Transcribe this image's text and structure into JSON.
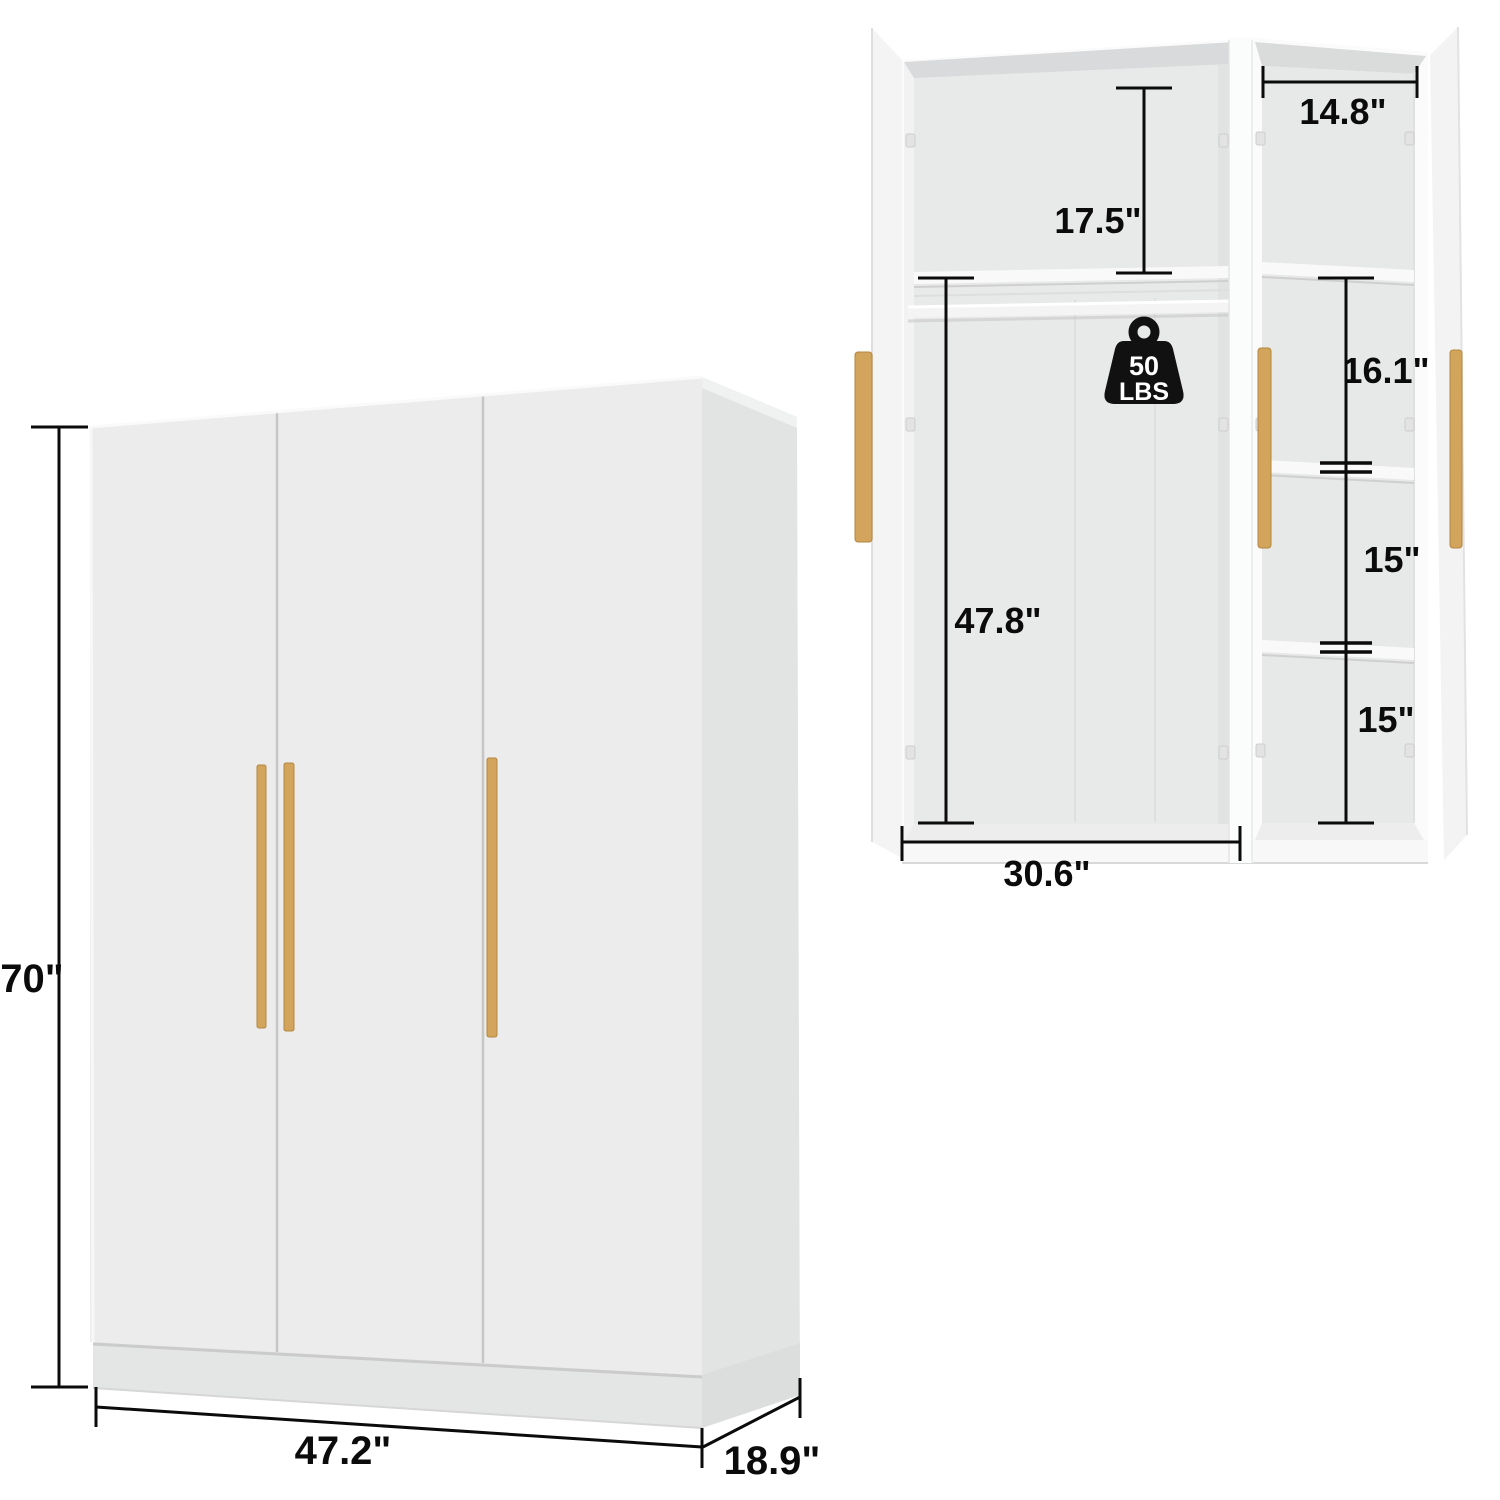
{
  "page": {
    "background": "#ffffff"
  },
  "colors": {
    "dimension_line": "#0b0b0b",
    "label_text": "#0b0b0b",
    "handle_wood": "#d2a45c",
    "handle_wood_shadow": "#b3873f",
    "cabinet_face": "#ececed",
    "cabinet_side": "#e2e3e3",
    "interior_wall": "#e8e9e9",
    "shelf_white": "#f9f9f9",
    "weight_badge": "#111111",
    "weight_text": "#ffffff"
  },
  "closed_view": {
    "height_label": "70\"",
    "width_label": "47.2\"",
    "depth_label": "18.9\""
  },
  "open_view": {
    "top_section_label": "17.5\"",
    "right_column_width_label": "14.8\"",
    "right_section_1_label": "16.1\"",
    "right_section_2_label": "15\"",
    "right_section_3_label": "15\"",
    "hanging_height_label": "47.8\"",
    "main_width_label": "30.6\"",
    "rod_capacity_value": "50",
    "rod_capacity_unit": "LBS"
  }
}
